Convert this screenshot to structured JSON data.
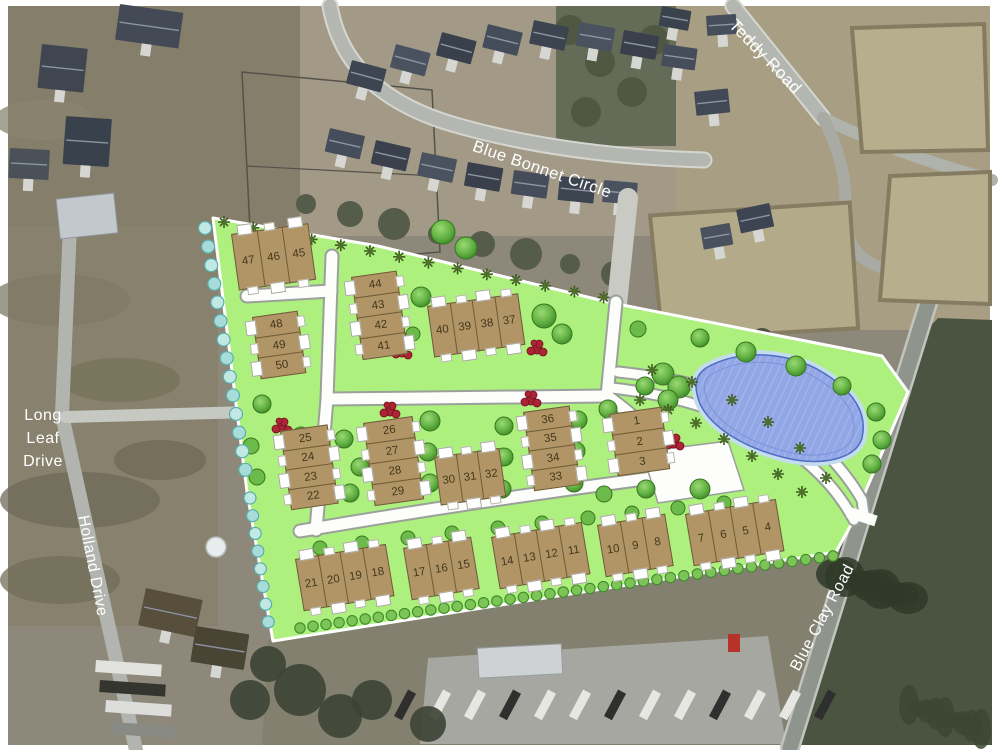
{
  "canvas": {
    "width": 1000,
    "height": 750
  },
  "road_labels": [
    {
      "id": "teddy",
      "text": "Teddy Road"
    },
    {
      "id": "bonnet",
      "text": "Blue Bonnet Circle"
    },
    {
      "id": "longleaf",
      "text": "Long Leaf Drive"
    },
    {
      "id": "holland",
      "text": "Holland Drive"
    },
    {
      "id": "blueclay",
      "text": "Blue Clay Road"
    }
  ],
  "site_plan": {
    "clusters": [
      {
        "id": "c45",
        "lots": [
          "47",
          "46",
          "45"
        ]
      },
      {
        "id": "c44",
        "lots": [
          "44",
          "43",
          "42",
          "41"
        ]
      },
      {
        "id": "c48",
        "lots": [
          "48",
          "49",
          "50"
        ]
      },
      {
        "id": "c40",
        "lots": [
          "40",
          "39",
          "38",
          "37"
        ]
      },
      {
        "id": "c25",
        "lots": [
          "25",
          "24",
          "23",
          "22"
        ]
      },
      {
        "id": "c26",
        "lots": [
          "26",
          "27",
          "28",
          "29"
        ]
      },
      {
        "id": "c30",
        "lots": [
          "30",
          "31",
          "32"
        ]
      },
      {
        "id": "c36",
        "lots": [
          "36",
          "35",
          "34",
          "33"
        ]
      },
      {
        "id": "c1",
        "lots": [
          "1",
          "2",
          "3"
        ]
      },
      {
        "id": "c21",
        "lots": [
          "21",
          "20",
          "19",
          "18"
        ]
      },
      {
        "id": "c17",
        "lots": [
          "17",
          "16",
          "15"
        ]
      },
      {
        "id": "c14",
        "lots": [
          "14",
          "13",
          "12",
          "11"
        ]
      },
      {
        "id": "c10",
        "lots": [
          "10",
          "9",
          "8"
        ]
      },
      {
        "id": "c7",
        "lots": [
          "7",
          "6",
          "5",
          "4"
        ]
      }
    ],
    "colors": {
      "lawn": "#adf07e",
      "building": "#b29566",
      "building_outline": "#6e5d38",
      "pond_fill": "#93a7e6",
      "pond_ring": "#c3dcee",
      "tree_green": "#4f9838",
      "red_bush": "#ab2534",
      "teal_bush": "#a8dcd8",
      "road_white": "#fdfdfb",
      "road_casing": "#9aa09a"
    }
  }
}
